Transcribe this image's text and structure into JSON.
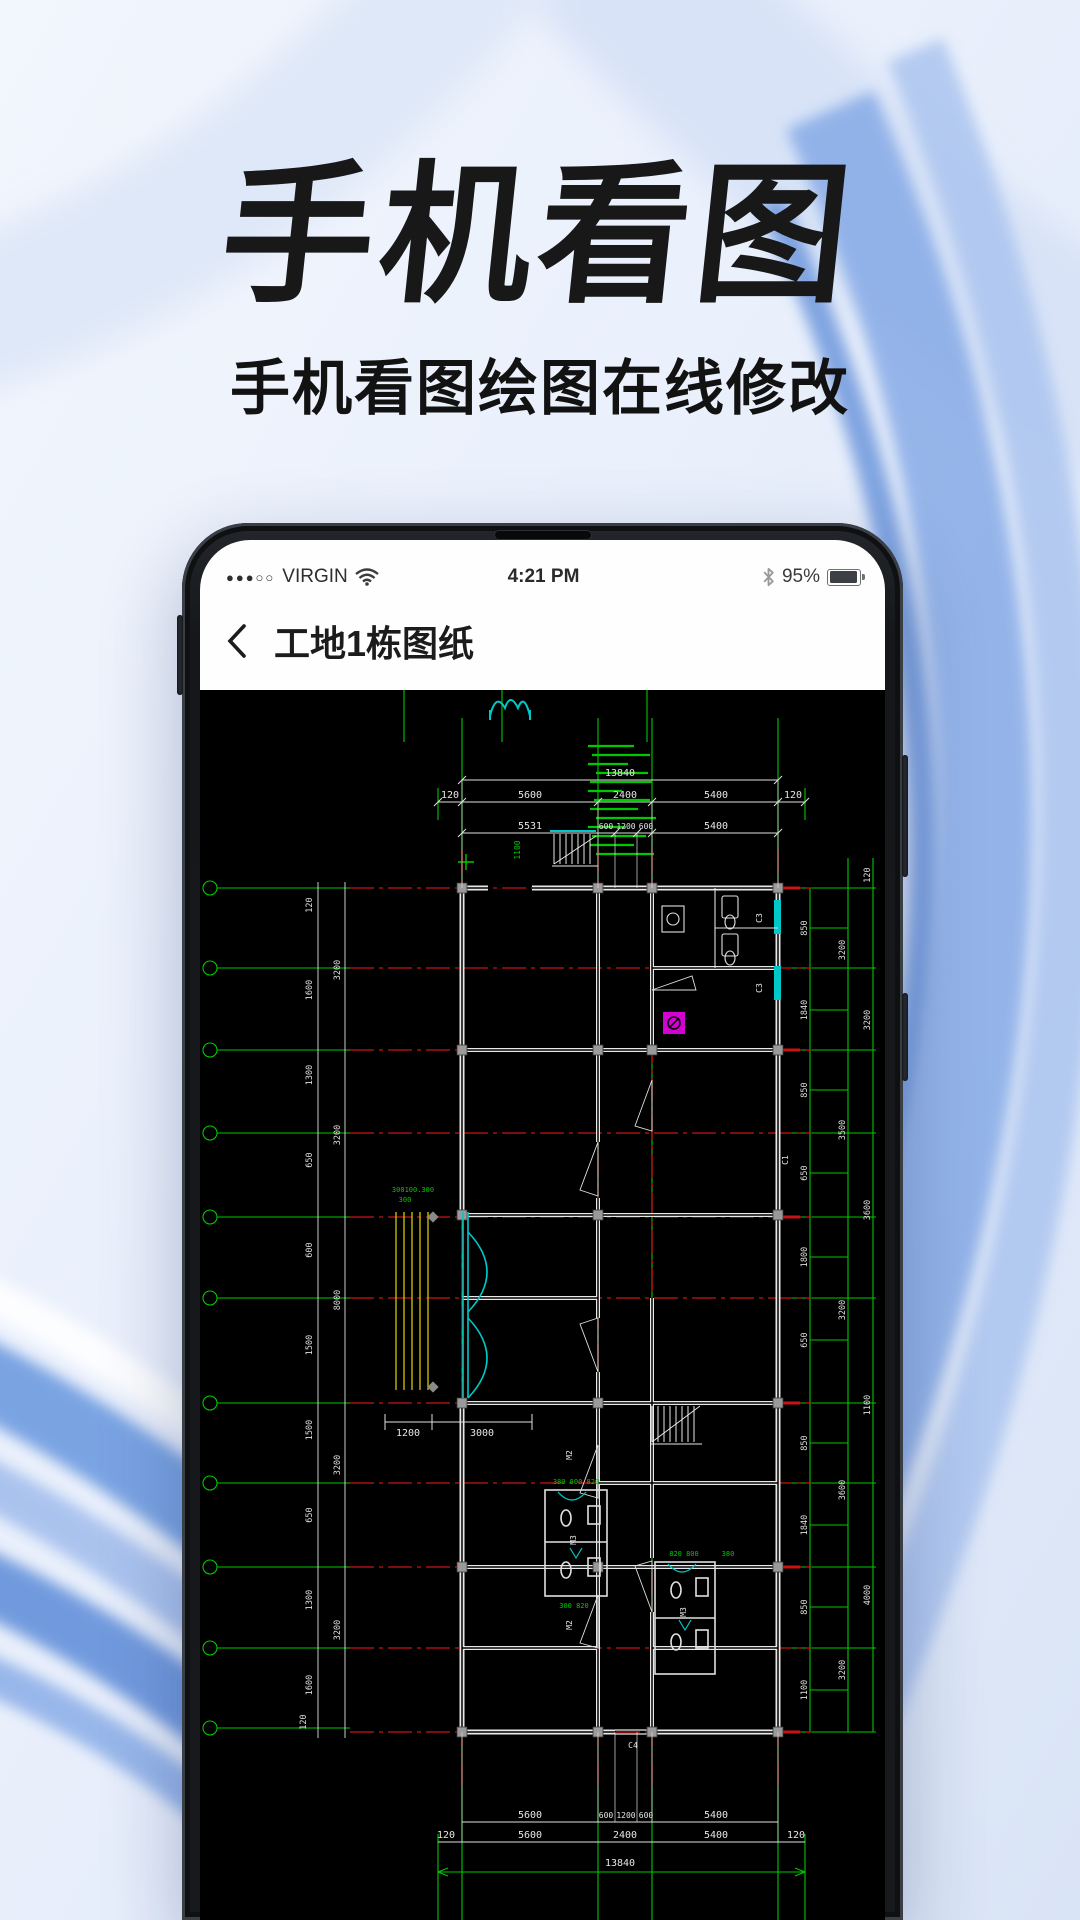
{
  "banner": {
    "title": "手机看图",
    "subtitle": "手机看图绘图在线修改"
  },
  "phone": {
    "statusbar": {
      "signal": "●●●○○",
      "carrier": "VIRGIN",
      "time": "4:21 PM",
      "battery_pct": "95%"
    },
    "navbar": {
      "title": "工地1栋图纸"
    }
  },
  "cad": {
    "top": {
      "total": "13840",
      "row1": [
        "120",
        "5600",
        "2400",
        "5400",
        "120"
      ],
      "row2": [
        "5531",
        "600",
        "1200",
        "600",
        "5400"
      ]
    },
    "bottom": {
      "row1": [
        "5600",
        "600",
        "1200",
        "600",
        "5400"
      ],
      "row2": [
        "120",
        "5600",
        "2400",
        "5400",
        "120"
      ],
      "total": "13840"
    },
    "left_inner": [
      "120",
      "1600",
      "1300",
      "650",
      "600",
      "1500",
      "1500",
      "650",
      "1300",
      "1600"
    ],
    "left_outer": [
      "3200",
      "3200",
      "8000",
      "3200",
      "3200"
    ],
    "right_inner": [
      "850",
      "1840",
      "850",
      "650",
      "1800",
      "650",
      "850",
      "1840",
      "850",
      "1100"
    ],
    "right_mid": [
      "3200",
      "3500",
      "3200",
      "3600",
      "3200"
    ],
    "right_outer": [
      "120",
      "3200",
      "3600",
      "1100",
      "4000"
    ],
    "labels": {
      "m2a": "M2",
      "m2b": "M2",
      "m3a": "M3",
      "m3b": "M3",
      "c1": "C1",
      "c3a": "C3",
      "c3b": "C3",
      "c4": "C4",
      "stair": "1100",
      "ramp_note": "300100.300",
      "ramp_note2": "300",
      "ramp_w": "1200",
      "ramp_l": "3000",
      "bath_top": "380 800 820",
      "bath_bot": "300 820",
      "bath2_top": "820 800",
      "bath2_side": "380",
      "corner": "120"
    }
  }
}
